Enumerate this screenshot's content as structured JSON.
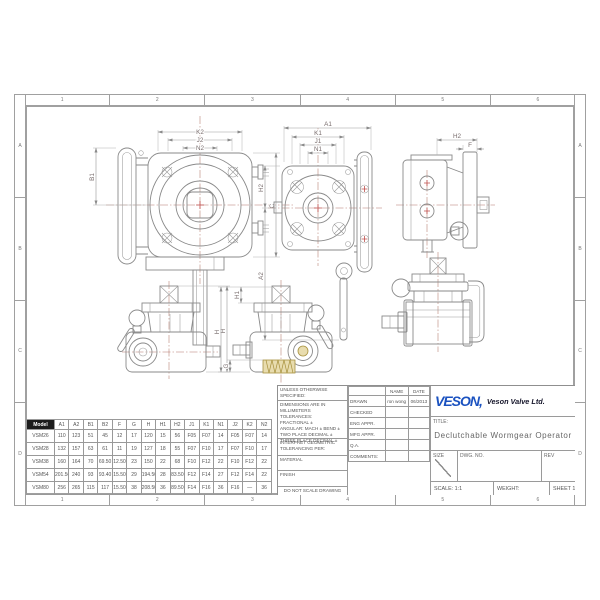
{
  "sheet": {
    "zone_cols": [
      "1",
      "2",
      "3",
      "4",
      "5",
      "6"
    ],
    "zone_rows": [
      "A",
      "B",
      "C",
      "D"
    ]
  },
  "colors": {
    "logo_blue": "#1b52c0",
    "line_gray": "#8a8a8a",
    "centerline_red": "#b4776b",
    "worm_tan": "#e8dcae"
  },
  "dims": {
    "front_k2": "K2",
    "front_j2": "J2",
    "front_n2": "N2",
    "front_b1": "B1",
    "front_c": "C",
    "back_a1": "A1",
    "back_k1": "K1",
    "back_j1": "J1",
    "back_n1": "N1",
    "back_h2": "H2",
    "back_a2": "A2",
    "side_h2": "H2",
    "side_f": "F",
    "elev_left_h": "H",
    "elev_right_h1": "H1",
    "elev_right_h": "H",
    "elev_right_g": "G"
  },
  "table": {
    "columns": [
      "Model",
      "A1",
      "A2",
      "B1",
      "B2",
      "F",
      "G",
      "H",
      "H1",
      "H2",
      "J1",
      "K1",
      "N1",
      "J2",
      "K2",
      "N2"
    ],
    "rows": [
      [
        "VSM26",
        "110",
        "123",
        "51",
        "45",
        "12",
        "17",
        "120",
        "15",
        "56",
        "F05",
        "F07",
        "14",
        "F05",
        "F07",
        "14"
      ],
      [
        "VSM28",
        "132",
        "157",
        "63",
        "61",
        "11",
        "19",
        "127",
        "18",
        "55",
        "F07",
        "F10",
        "17",
        "F07",
        "F10",
        "17"
      ],
      [
        "VSM38",
        "160",
        "164",
        "70",
        "69.50",
        "12.50",
        "23",
        "150",
        "22",
        "68",
        "F10",
        "F12",
        "22",
        "F10",
        "F12",
        "22"
      ],
      [
        "VSM54",
        "201.50",
        "240",
        "93",
        "93.40",
        "15.50",
        "29",
        "194.50",
        "28",
        "83.50",
        "F12",
        "F14",
        "27",
        "F12",
        "F14",
        "22"
      ],
      [
        "VSM80",
        "256",
        "265",
        "115",
        "117",
        "15.50",
        "38",
        "208.50",
        "36",
        "89.50",
        "F14",
        "F16",
        "36",
        "F16",
        "—",
        "36"
      ]
    ]
  },
  "title_block": {
    "notes": {
      "unless": "UNLESS OTHERWISE SPECIFIED:",
      "dims_in": "DIMENSIONS ARE IN MILLIMETERS",
      "tolerances": "TOLERANCES:",
      "fractional": "FRACTIONAL ±",
      "angular": "ANGULAR: MACH ±  BEND ±",
      "two_place": "TWO PLACE DECIMAL    ±",
      "three_place": "THREE PLACE DECIMAL  ±",
      "interpret": "INTERPRET GEOMETRIC",
      "tolerancing_per": "TOLERANCING PER:",
      "material": "MATERIAL",
      "finish": "FINISH",
      "do_not_scale": "DO NOT SCALE DRAWING"
    },
    "approvals": {
      "name_header": "NAME",
      "date_header": "DATE",
      "rows": [
        {
          "label": "DRAWN",
          "name": "ron wong",
          "date": "06/2013"
        },
        {
          "label": "CHECKED",
          "name": "",
          "date": ""
        },
        {
          "label": "ENG APPR.",
          "name": "",
          "date": ""
        },
        {
          "label": "MFG APPR.",
          "name": "",
          "date": ""
        },
        {
          "label": "Q.A.",
          "name": "",
          "date": ""
        },
        {
          "label": "COMMENTS:",
          "name": "",
          "date": ""
        }
      ]
    },
    "company": {
      "logo": "VESON,",
      "name": "Veson Valve Ltd."
    },
    "title_label": "TITLE:",
    "title": "Declutchable Wormgear Operator",
    "size_label": "SIZE",
    "dwg_label": "DWG.  NO.",
    "rev_label": "REV",
    "scale": "SCALE: 1:1",
    "weight": "WEIGHT:",
    "sheet": "SHEET 1 OF 1"
  }
}
